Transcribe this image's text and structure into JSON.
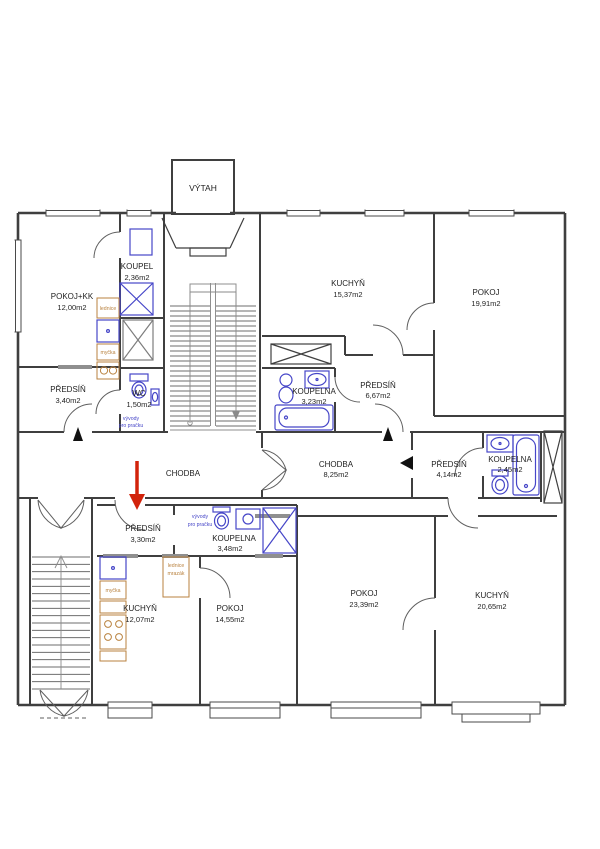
{
  "colors": {
    "wall": "#3f3f3f",
    "fixture": "#4646c8",
    "appliance": "#b9823f",
    "arrow": "#d2230b",
    "lintel": "#8f8f8f",
    "ink": "#1f1f1f"
  },
  "elevator": {
    "label": "VÝTAH"
  },
  "rooms": [
    {
      "id": "pokoj-kk",
      "name": "POKOJ+KK",
      "area": "12,00m2"
    },
    {
      "id": "koupel",
      "name": "KOUPEL",
      "area": "2,36m2"
    },
    {
      "id": "predsin-1",
      "name": "PŘEDSÍŇ",
      "area": "3,40m2"
    },
    {
      "id": "wc",
      "name": "WC",
      "area": "1,50m2"
    },
    {
      "id": "kuchyn-2",
      "name": "KUCHYŇ",
      "area": "15,37m2"
    },
    {
      "id": "pokoj-2",
      "name": "POKOJ",
      "area": "19,91m2"
    },
    {
      "id": "koupelna-2",
      "name": "KOUPELNA",
      "area": "3,23m2"
    },
    {
      "id": "predsin-2",
      "name": "PŘEDSÍŇ",
      "area": "6,67m2"
    },
    {
      "id": "chodba-l",
      "name": "CHODBA",
      "area": ""
    },
    {
      "id": "chodba-r",
      "name": "CHODBA",
      "area": "8,25m2"
    },
    {
      "id": "predsin-3",
      "name": "PŘEDSÍŇ",
      "area": "4,14m2"
    },
    {
      "id": "koupelna-3",
      "name": "KOUPELNA",
      "area": "2,45m2"
    },
    {
      "id": "predsin-4",
      "name": "PŘEDSÍŇ",
      "area": "3,30m2"
    },
    {
      "id": "koupelna-4",
      "name": "KOUPELNA",
      "area": "3,48m2"
    },
    {
      "id": "kuchyn-4",
      "name": "KUCHYŇ",
      "area": "12,07m2"
    },
    {
      "id": "pokoj-4",
      "name": "POKOJ",
      "area": "14,55m2"
    },
    {
      "id": "pokoj-5",
      "name": "POKOJ",
      "area": "23,39m2"
    },
    {
      "id": "kuchyn-5",
      "name": "KUCHYŇ",
      "area": "20,65m2"
    }
  ],
  "fixture_labels": {
    "fridge": "lednice",
    "dishwasher": "myčka",
    "freezer": "mrazák",
    "washer_hookup": [
      "vývody",
      "pro pračku"
    ]
  }
}
